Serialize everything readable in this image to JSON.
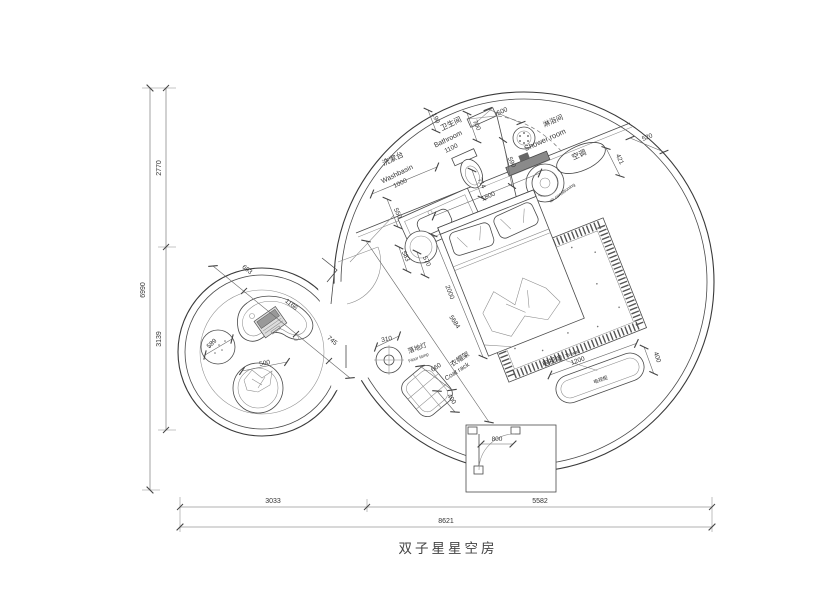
{
  "title": "双子星星空房",
  "rooms": {
    "washbasin": {
      "cn": "洗漱台",
      "en": "Washbasin",
      "size": "1000"
    },
    "bathroom": {
      "cn": "卫生间",
      "en": "Bathroom",
      "size": "1100"
    },
    "shower": {
      "cn": "淋浴间",
      "en": "Shower room"
    },
    "air_conditioner": {
      "cn": "空调",
      "en": "air conditioning"
    },
    "tv_wall": {
      "cn": "电视墙",
      "en": "TV wall"
    },
    "tv_cabinet": {
      "cn": "电视柜"
    },
    "coat_rack": {
      "cn": "衣帽架",
      "en": "Coat rack",
      "width": "660",
      "depth": "400"
    },
    "floor_lamp": {
      "cn": "落地灯",
      "en": "Floor lamp",
      "size": "310"
    }
  },
  "dimensions": {
    "overall_width": "8621",
    "left_width": "3033",
    "right_width": "5582",
    "overall_height": "6990",
    "upper_height": "2770",
    "lower_height": "3139",
    "bath_190": "190",
    "bath_700": "700",
    "bath_500": "500",
    "bath_590": "590",
    "bath_550": "550",
    "bath_714": "714",
    "bath_1800": "1800",
    "ac_520": "520",
    "ac_421": "421",
    "bed_583": "583",
    "bed_570": "570",
    "bed_2000": "2000",
    "room_5684": "5684",
    "door_800": "800",
    "tv_1200": "1200",
    "tv_400": "400",
    "lounge_693": "693",
    "lounge_1166": "1166",
    "lounge_745": "745",
    "stool_589": "589",
    "chair_500": "500"
  }
}
